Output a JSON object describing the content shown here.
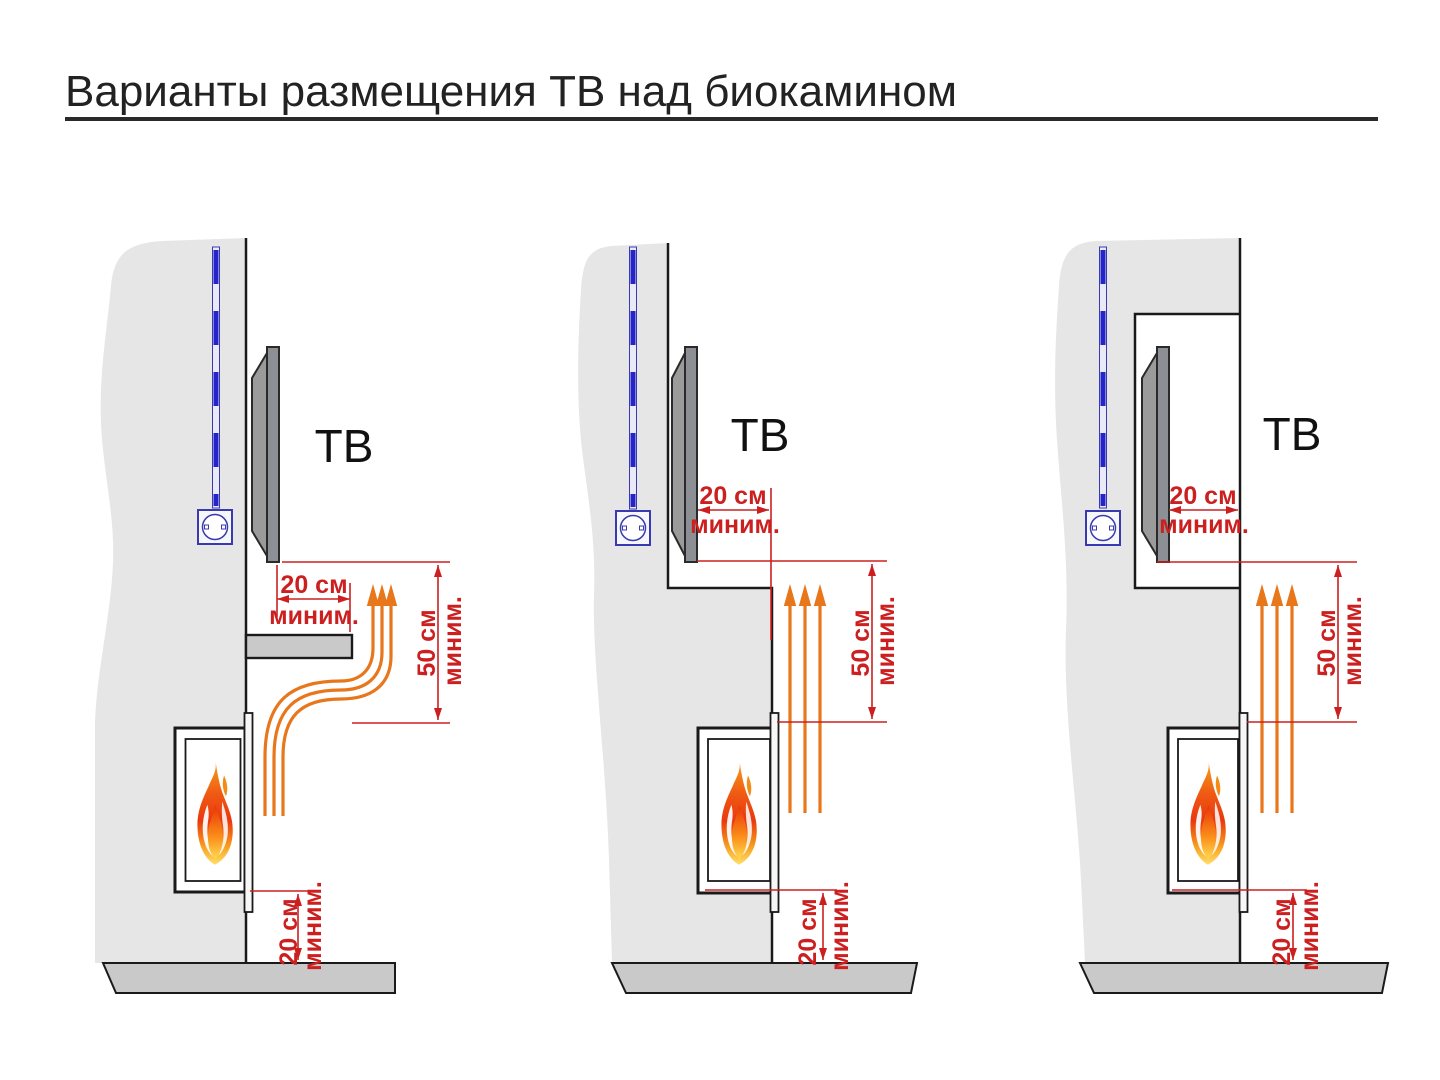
{
  "page": {
    "title": "Варианты размещения ТВ над биокамином"
  },
  "colors": {
    "dimension_red": "#cc2020",
    "heat_orange": "#e8761b",
    "cable_blue": "#2424c8",
    "outlet_blue": "#3a3ab0",
    "wall_gray": "#e6e6e6",
    "slab_gray": "#c9c9c9",
    "tv_gray": "#8c8f93",
    "outline_black": "#1a1a1a",
    "title_text": "#222222"
  },
  "diagrams": [
    {
      "id": "tv-open-wall-with-shelf",
      "tv_label": "ТВ",
      "clearance_side": {
        "value": "20 см",
        "qualifier": "миним."
      },
      "clearance_height": {
        "value": "50 см",
        "qualifier": "миним."
      },
      "clearance_floor": {
        "value": "20 см",
        "qualifier": "миним."
      }
    },
    {
      "id": "tv-on-stepped-wall",
      "tv_label": "ТВ",
      "clearance_side": {
        "value": "20 см",
        "qualifier": "миним."
      },
      "clearance_height": {
        "value": "50 см",
        "qualifier": "миним."
      },
      "clearance_floor": {
        "value": "20 см",
        "qualifier": "миним."
      }
    },
    {
      "id": "tv-recessed-in-niche",
      "tv_label": "ТВ",
      "clearance_side": {
        "value": "20 см",
        "qualifier": "миним."
      },
      "clearance_height": {
        "value": "50 см",
        "qualifier": "миним."
      },
      "clearance_floor": {
        "value": "20 см",
        "qualifier": "миним."
      }
    }
  ]
}
